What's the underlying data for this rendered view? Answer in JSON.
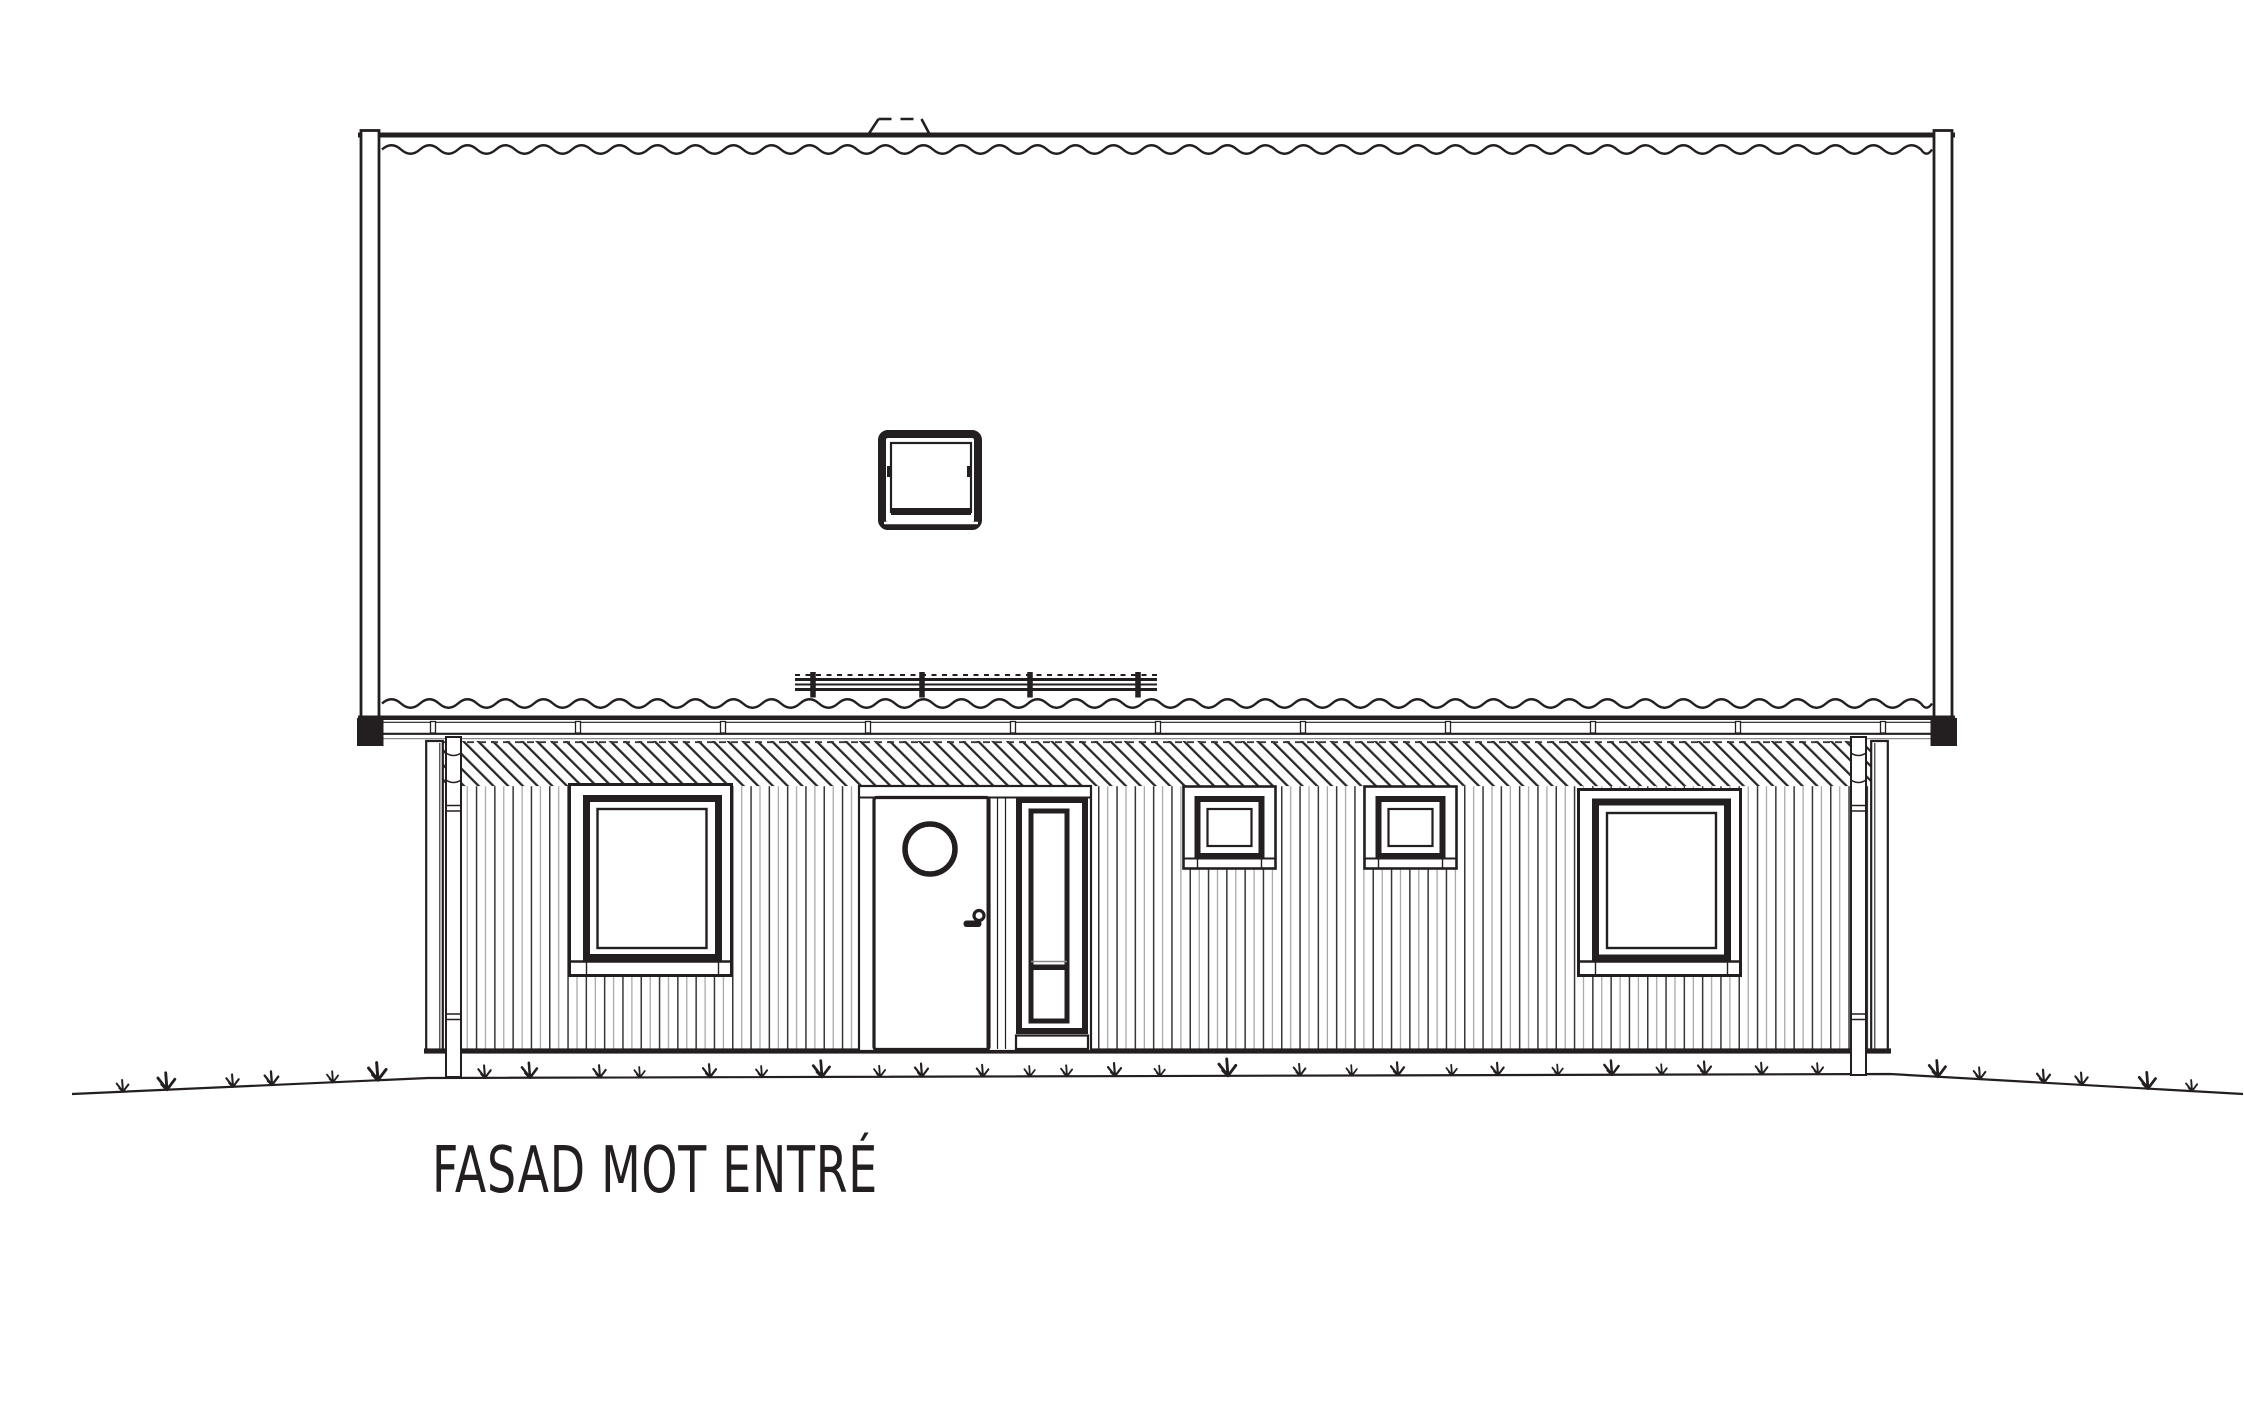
{
  "title": "FASAD MOT ENTRÉ",
  "drawing": {
    "type": "architectural-elevation",
    "colors": {
      "ink": "#231f20",
      "gray": "#8a8a8a",
      "background": "#ffffff"
    },
    "elements": [
      "roof-surface",
      "ridge-vent",
      "roof-window",
      "snow-guard-rail",
      "bargeboard-left",
      "bargeboard-right",
      "eave-gutter",
      "hatched-frieze-band",
      "vertical-siding",
      "corner-boards",
      "downpipe-left",
      "downpipe-right",
      "window-left",
      "entrance-door",
      "door-porthole",
      "door-sidelight",
      "small-window-left",
      "small-window-right",
      "window-right",
      "ground-line",
      "grass-tufts",
      "title-label"
    ]
  }
}
